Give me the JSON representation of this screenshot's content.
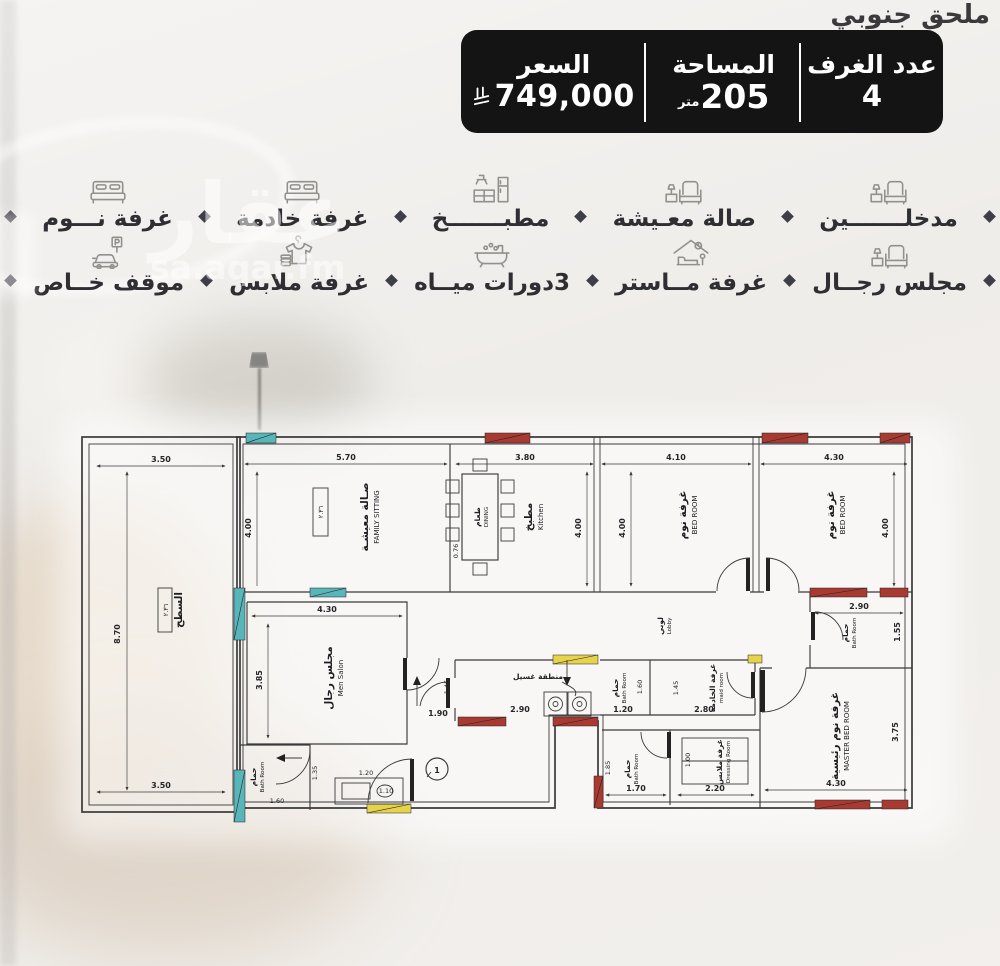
{
  "colors": {
    "bar_bg": "#141414",
    "window_red": "#a93a32",
    "window_teal": "#58b5b9",
    "door_yellow": "#e7d24b",
    "wall": "#3a3a3a",
    "background": "#e9e6e2"
  },
  "header": {
    "title": "ملحق جنوبي"
  },
  "info_bar": {
    "rooms_label": "عدد الغرف",
    "rooms_value": "4",
    "area_label": "المساحة",
    "area_value": "205",
    "area_unit": "متر",
    "price_label": "السعر",
    "price_value": "749,000",
    "currency_icon": "saudi-riyal-symbol"
  },
  "watermark": {
    "logo": "عقار",
    "site": "sa.aqar.fm"
  },
  "features": {
    "row1": [
      {
        "label": "مدخلـــــــين",
        "icon": "sofa-icon"
      },
      {
        "label": "صالة معـيشة",
        "icon": "sofa-icon"
      },
      {
        "label": "مطبـــــــخ",
        "icon": "kitchen-icon"
      },
      {
        "label": "غرفة خادمة",
        "icon": "bed-icon"
      },
      {
        "label": "غرفة نـــوم",
        "icon": "bed-icon"
      }
    ],
    "row2": [
      {
        "label": "مجلس رجــال",
        "icon": "sofa-icon"
      },
      {
        "label": "غرفة مــاستر",
        "icon": "master-bed-icon"
      },
      {
        "label": "3دورات ميــاه",
        "icon": "bathtub-icon"
      },
      {
        "label": "غرفة ملابس",
        "icon": "clothes-icon"
      },
      {
        "label": "موقف خــاص",
        "icon": "parking-icon"
      }
    ]
  },
  "plan": {
    "rooms": {
      "family": {
        "ar": "صـالة معيشـة",
        "en": "FAMILY SITTING"
      },
      "dining": {
        "ar": "طعام",
        "en": "DINING"
      },
      "kitchen": {
        "ar": "مطبخ",
        "en": "Kitchen"
      },
      "bed": {
        "ar": "غرفة نوم",
        "en": "BED ROOM"
      },
      "master": {
        "ar": "غرفة نوم رئيسية",
        "en": "MASTER BED ROOM"
      },
      "salon": {
        "ar": "مجلس رجال",
        "en": "Men Salon"
      },
      "bath": {
        "ar": "حمام",
        "en": "Bath Room"
      },
      "maid": {
        "ar": "غرفة الخادمة",
        "en": "maid room"
      },
      "lobby": {
        "ar": "لوبي",
        "en": "Lobby"
      },
      "laundry": {
        "ar": "منطقة غسيل"
      },
      "dressing": {
        "ar": "غرفة ملابس",
        "en": "Dressing Room"
      },
      "terrace": {
        "ar": "السطح"
      }
    },
    "dims": {
      "terrace_top": "3.50",
      "terrace_side": "8.70",
      "terrace_bottom": "3.50",
      "family_w": "5.70",
      "family_h": "4.00",
      "kitchen_w": "3.80",
      "kitchen_h": "4.00",
      "table_w": "0.76",
      "bed1_w": "4.10",
      "bed1_h": "4.00",
      "bed2_w": "4.30",
      "bed2_h": "4.00",
      "bath_right_w": "2.90",
      "bath_right_h": "1.55",
      "master_h": "3.75",
      "master_w": "4.30",
      "salon_w": "4.30",
      "salon_h": "3.85",
      "corridor_w": "1.90",
      "pass1": "1.45",
      "pass2": "1.45",
      "laundry_w": "2.90",
      "bath_mid_w": "1.20",
      "bath_mid_h": "1.60",
      "maid_w": "2.80",
      "sink_w": "1.20",
      "door_w": "1.10",
      "bath_bottom_w": "1.70",
      "bath_bottom_h": "1.85",
      "dressing_w": "2.20",
      "dressing_h": "1.00",
      "bath_small_w": "1.60",
      "bath_small_h": "1.35"
    },
    "level_mark": "٢.٣٦",
    "key_mark": "1"
  }
}
